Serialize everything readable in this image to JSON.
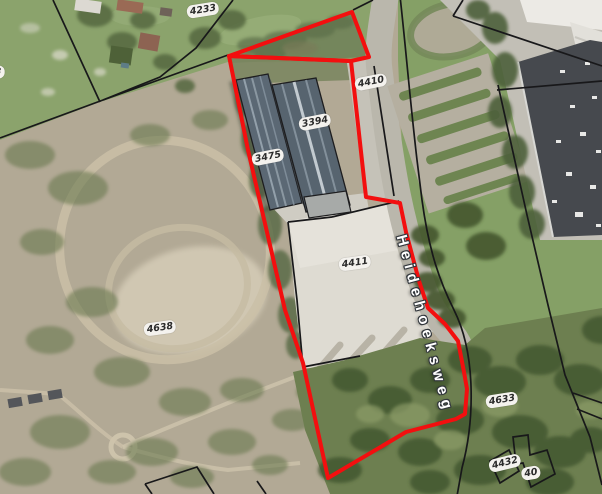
{
  "map": {
    "parcel_labels": [
      {
        "text": "4233"
      },
      {
        "text": "3"
      },
      {
        "text": "4410"
      },
      {
        "text": "3394"
      },
      {
        "text": "3475"
      },
      {
        "text": "4411"
      },
      {
        "text": "4638"
      },
      {
        "text": "4633"
      },
      {
        "text": "4432"
      },
      {
        "text": "40"
      }
    ],
    "street_labels": [
      {
        "text": "Heidehoeksweg"
      }
    ],
    "colors": {
      "highlight_outline": "#f30f0f",
      "cadastral_line": "#18181a",
      "label_background": "#f4f2ee",
      "label_text": "#2b2b2b",
      "street_label_text": "#ffffff"
    }
  }
}
